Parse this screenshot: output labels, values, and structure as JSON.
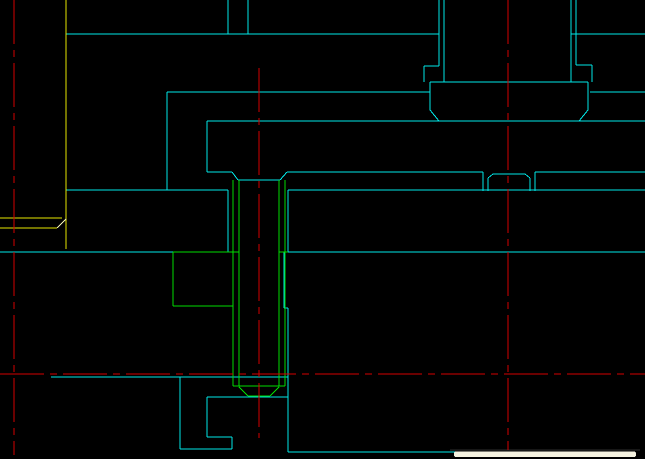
{
  "app": {
    "name": "cad-drawing-viewport",
    "description": "AutoCAD-style section view of screw and bolt assembly"
  },
  "canvas": {
    "width": 645,
    "height": 459,
    "background": "#000000"
  },
  "colors": {
    "cyan": "#00e8e8",
    "green": "#00dd00",
    "yellow": "#e6e600",
    "pale": "#f0f0b4",
    "red": "#d40000",
    "dark": "#2e2e2e",
    "cream": "#f4f1df"
  },
  "centerlines": {
    "color_key": "red",
    "dash_pattern": "44 6 7 6",
    "lines": [
      {
        "name": "vertical-centerline-left",
        "x1": 14,
        "y1": 0,
        "x2": 14,
        "y2": 455
      },
      {
        "name": "vertical-centerline-screw",
        "x1": 259,
        "y1": 68,
        "x2": 259,
        "y2": 438
      },
      {
        "name": "vertical-centerline-bolt",
        "x1": 508,
        "y1": 0,
        "x2": 508,
        "y2": 450
      },
      {
        "name": "horizontal-centerline-main",
        "x1": 0,
        "y1": 374,
        "x2": 645,
        "y2": 374
      }
    ]
  },
  "geometry": {
    "lines": [
      [
        66,
        34,
        439,
        34,
        "cyan"
      ],
      [
        571,
        34,
        645,
        34,
        "cyan"
      ],
      [
        228,
        0,
        228,
        34,
        "cyan"
      ],
      [
        248,
        0,
        248,
        34,
        "cyan"
      ],
      [
        439,
        0,
        439,
        66,
        "cyan"
      ],
      [
        444,
        0,
        444,
        82,
        "cyan"
      ],
      [
        571,
        0,
        571,
        82,
        "cyan"
      ],
      [
        576,
        0,
        576,
        65,
        "cyan"
      ],
      [
        424,
        66,
        439,
        66,
        "cyan"
      ],
      [
        424,
        66,
        424,
        82,
        "cyan"
      ],
      [
        576,
        65,
        592,
        65,
        "cyan"
      ],
      [
        592,
        65,
        592,
        82,
        "cyan"
      ],
      [
        430,
        82,
        588,
        82,
        "cyan"
      ],
      [
        430,
        82,
        430,
        110,
        "cyan"
      ],
      [
        588,
        82,
        588,
        110,
        "cyan"
      ],
      [
        430,
        110,
        439,
        121,
        "cyan"
      ],
      [
        588,
        110,
        579,
        121,
        "cyan"
      ],
      [
        167,
        92,
        430,
        92,
        "cyan"
      ],
      [
        590,
        92,
        645,
        92,
        "cyan"
      ],
      [
        167,
        92,
        167,
        190,
        "cyan"
      ],
      [
        207,
        121,
        645,
        121,
        "cyan"
      ],
      [
        207,
        121,
        207,
        172,
        "cyan"
      ],
      [
        207,
        172,
        232,
        172,
        "cyan"
      ],
      [
        287,
        172,
        483,
        172,
        "cyan"
      ],
      [
        535,
        172,
        645,
        172,
        "cyan"
      ],
      [
        232,
        172,
        238,
        180,
        "cyan"
      ],
      [
        287,
        172,
        280,
        180,
        "cyan"
      ],
      [
        238,
        180,
        280,
        180,
        "cyan"
      ],
      [
        66,
        190,
        228,
        190,
        "cyan"
      ],
      [
        288,
        190,
        645,
        190,
        "cyan"
      ],
      [
        228,
        190,
        228,
        252,
        "cyan"
      ],
      [
        288,
        190,
        288,
        252,
        "cyan"
      ],
      [
        284,
        252,
        284,
        308,
        "cyan"
      ],
      [
        284,
        308,
        288,
        308,
        "cyan"
      ],
      [
        288,
        308,
        288,
        452,
        "cyan"
      ],
      [
        0,
        252,
        173,
        252,
        "cyan"
      ],
      [
        288,
        252,
        645,
        252,
        "cyan"
      ],
      [
        51,
        377,
        288,
        377,
        "cyan"
      ],
      [
        207,
        397,
        288,
        397,
        "cyan"
      ],
      [
        207,
        397,
        207,
        437,
        "cyan"
      ],
      [
        207,
        437,
        232,
        437,
        "cyan"
      ],
      [
        232,
        437,
        232,
        449,
        "cyan"
      ],
      [
        180,
        449,
        232,
        449,
        "cyan"
      ],
      [
        180,
        377,
        180,
        449,
        "cyan"
      ],
      [
        288,
        452,
        460,
        452,
        "cyan"
      ],
      [
        483,
        172,
        483,
        191,
        "cyan"
      ],
      [
        535,
        172,
        535,
        191,
        "cyan"
      ],
      [
        488,
        178,
        488,
        191,
        "cyan"
      ],
      [
        530,
        178,
        530,
        191,
        "cyan"
      ],
      [
        493,
        174,
        525,
        174,
        "cyan"
      ],
      [
        488,
        178,
        493,
        174,
        "cyan"
      ],
      [
        530,
        178,
        525,
        174,
        "cyan"
      ],
      [
        173,
        252,
        239,
        252,
        "green"
      ],
      [
        279,
        252,
        288,
        252,
        "green"
      ],
      [
        173,
        252,
        173,
        306,
        "green"
      ],
      [
        173,
        306,
        233,
        306,
        "green"
      ],
      [
        233,
        180,
        233,
        386,
        "green"
      ],
      [
        239,
        180,
        239,
        386,
        "green"
      ],
      [
        279,
        180,
        279,
        386,
        "green"
      ],
      [
        285,
        180,
        285,
        386,
        "green"
      ],
      [
        233,
        386,
        285,
        386,
        "green"
      ],
      [
        239,
        387,
        248,
        396,
        "green"
      ],
      [
        279,
        387,
        270,
        396,
        "green"
      ],
      [
        248,
        396,
        270,
        396,
        "green"
      ],
      [
        66,
        0,
        66,
        249,
        "yellow"
      ],
      [
        0,
        218,
        62,
        218,
        "yellow"
      ],
      [
        0,
        228,
        57,
        228,
        "yellow"
      ],
      [
        57,
        228,
        66,
        219,
        "pale"
      ],
      [
        450,
        450,
        640,
        450,
        "dark"
      ]
    ]
  },
  "overlays": {
    "white_bar": {
      "x": 454,
      "y": 451.5,
      "width": 182,
      "height": 5.5,
      "color_key": "cream"
    }
  }
}
